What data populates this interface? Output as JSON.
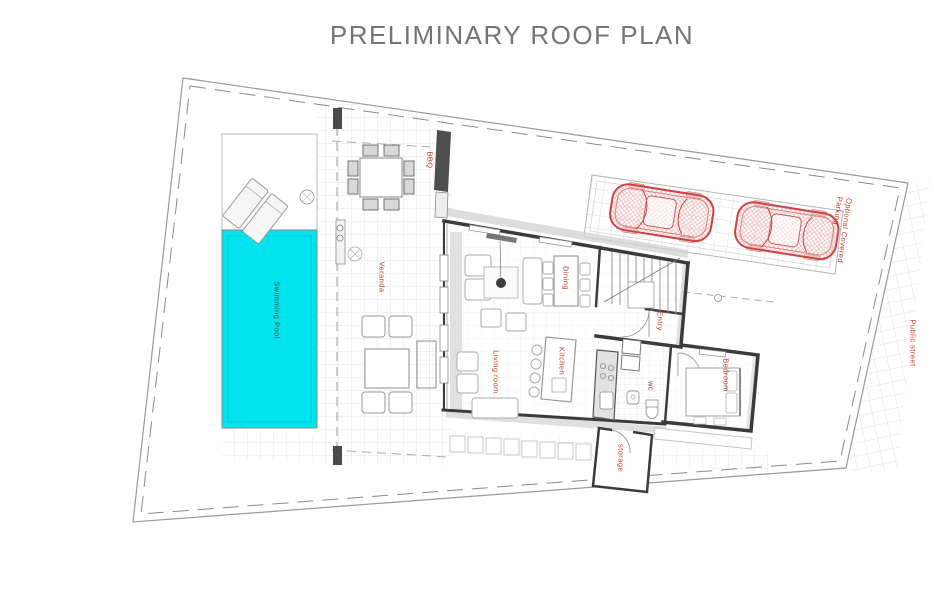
{
  "title": "PRELIMINARY ROOF PLAN",
  "colors": {
    "pool_cyan": "#00e4ef",
    "label_red": "#c0392b",
    "title_gray": "#757575",
    "car_red": "#c84545",
    "wall_dark": "#3b3b3b"
  },
  "plan": {
    "type": "architectural-roof-plan",
    "labels": {
      "swimming_pool": "Swimming Pool",
      "veranda": "Veranda",
      "bbq": "BBQ",
      "dining": "Dining",
      "living_room": "Living room",
      "kitchen": "Kitchen",
      "entry": "Entry",
      "wc": "wc",
      "bedroom": "Bedroom",
      "storage": "storage",
      "parking": "Optional Covered Parking",
      "street": "Public street"
    },
    "features": {
      "cars_in_parking": 2
    }
  }
}
